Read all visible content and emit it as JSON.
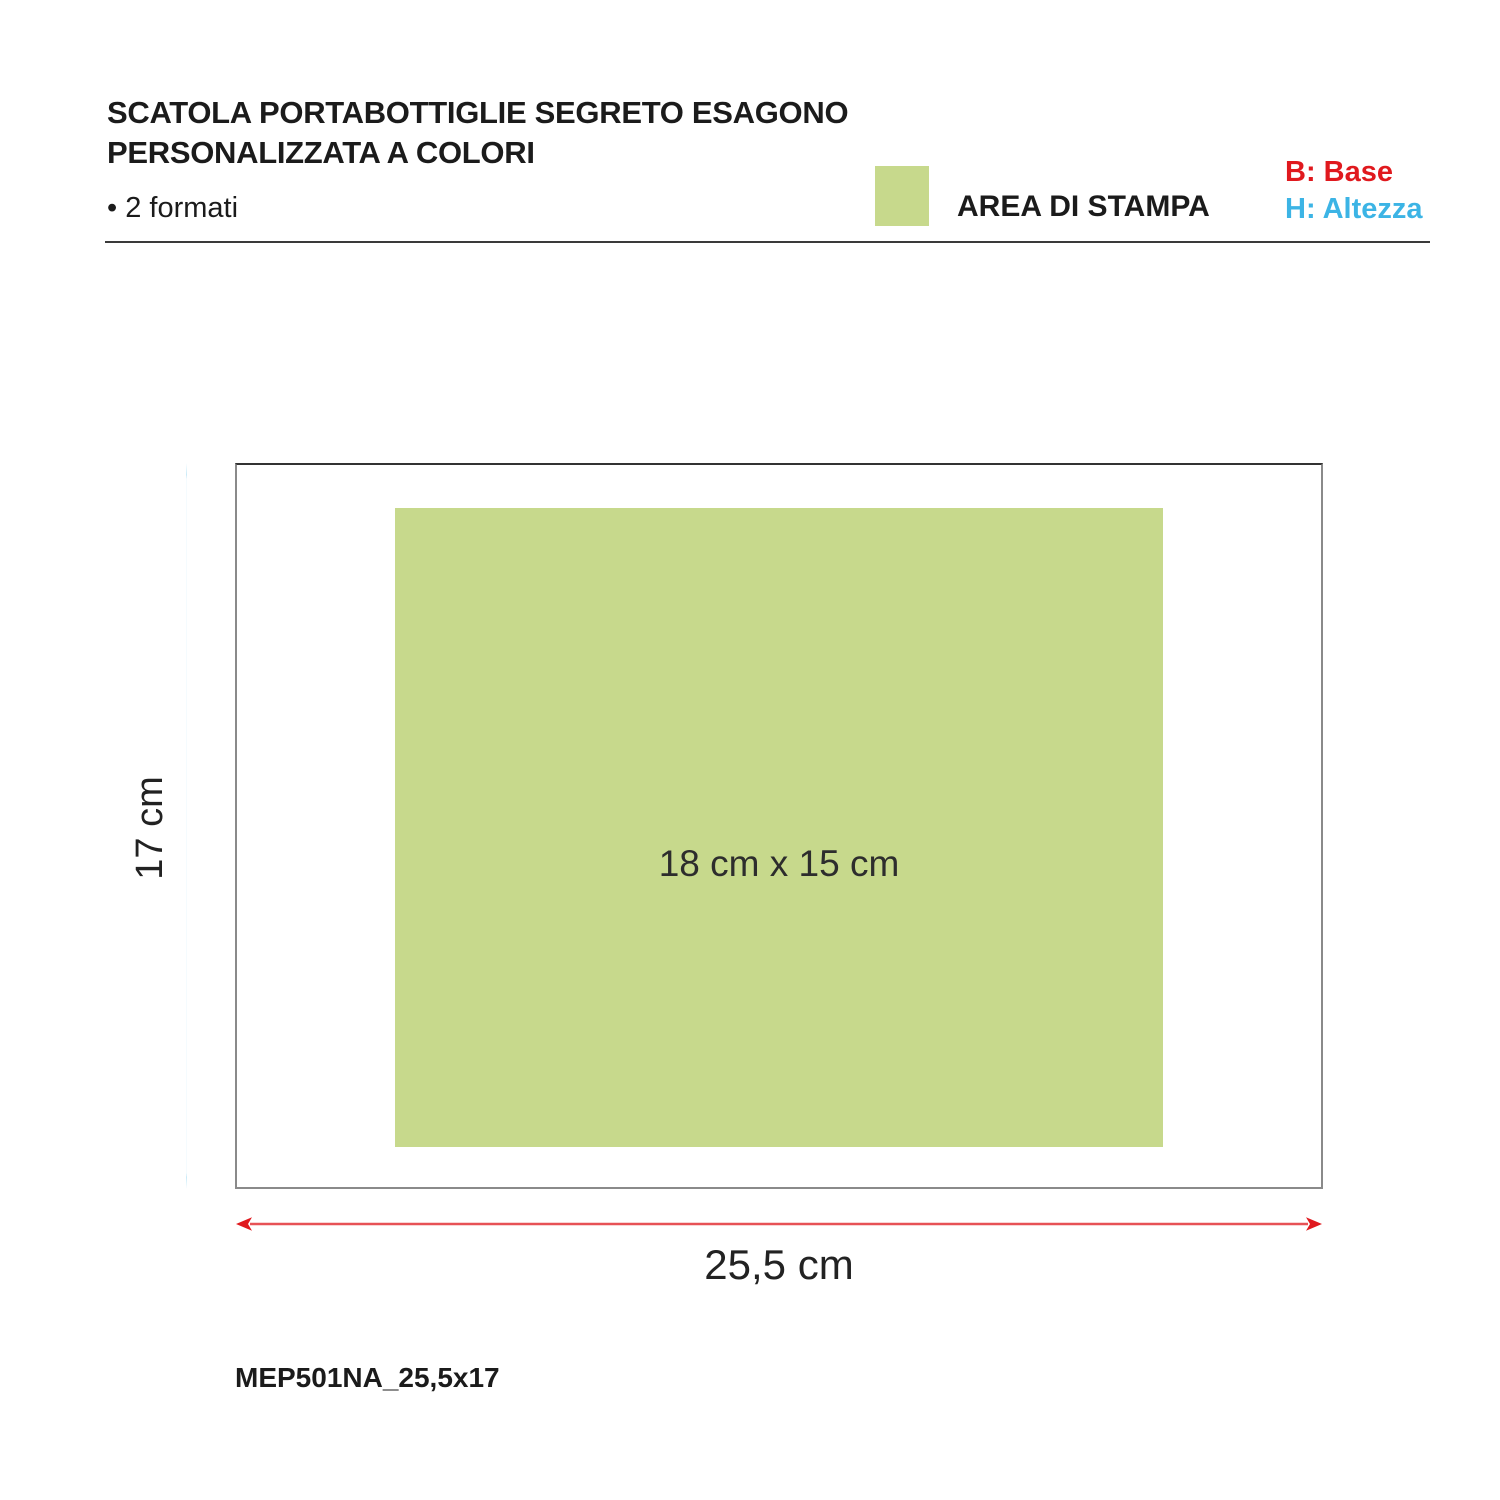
{
  "header": {
    "title_line1": "SCATOLA PORTABOTTIGLIE SEGRETO ESAGONO",
    "title_line2": "PERSONALIZZATA A COLORI",
    "formats_note": "• 2 formati"
  },
  "legend": {
    "print_area_label": "AREA DI STAMPA",
    "base_label": "B: Base",
    "height_label": "H: Altezza"
  },
  "diagram": {
    "print_area_size": "18 cm x 15 cm",
    "box_height": "17 cm",
    "box_width": "25,5 cm",
    "product_code": "MEP501NA_25,5x17"
  },
  "colors": {
    "area_green": "#c7d98c",
    "base_red": "#e0191e",
    "height_cyan": "#3cb4e5"
  }
}
